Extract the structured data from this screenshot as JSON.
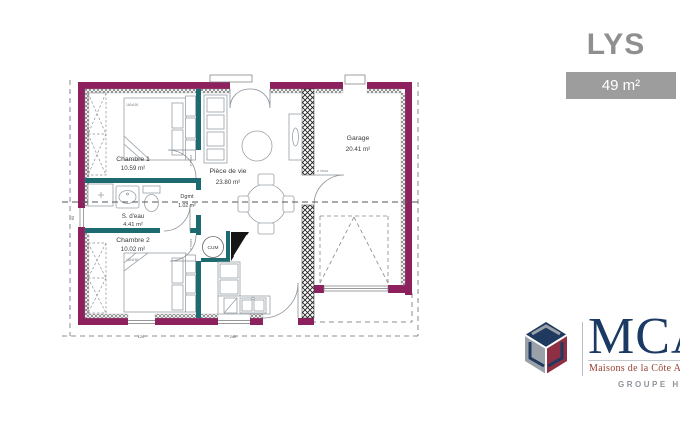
{
  "header": {
    "model_name": "LYS",
    "surface": "49 m²"
  },
  "rooms": {
    "chambre1": {
      "name": "Chambre 1",
      "area": "10.59 m²"
    },
    "sdeau": {
      "name": "S. d'eau",
      "area": "4.41 m²"
    },
    "chambre2": {
      "name": "Chambre 2",
      "area": "10.02 m²"
    },
    "dgmt": {
      "name": "Dgmt",
      "area": "1.02 m²"
    },
    "piece_de_vie": {
      "name": "Pièce de vie",
      "area": "23.80 m²"
    },
    "garage": {
      "name": "Garage",
      "area": "20.41 m²"
    }
  },
  "annotations": {
    "water_heater": "CUM",
    "door_ref": "P 75004",
    "bed_size": "140x190",
    "dim_window_chambre2": "120",
    "dim_window_kitchen": "240",
    "dim_window_sdeau": "60"
  },
  "logo": {
    "brand": "MCA",
    "tagline": "Maisons de la Côte Atlantique",
    "group": "GROUPE HEXAOM"
  },
  "colors": {
    "exterior_wall": "#8d215e",
    "interior_wall": "#1d6b70",
    "badge_gray": "#9d9d9d",
    "brand_navy": "#1f3a5e",
    "brand_maroon": "#8e2f44",
    "brand_gray": "#9aa1a8"
  }
}
